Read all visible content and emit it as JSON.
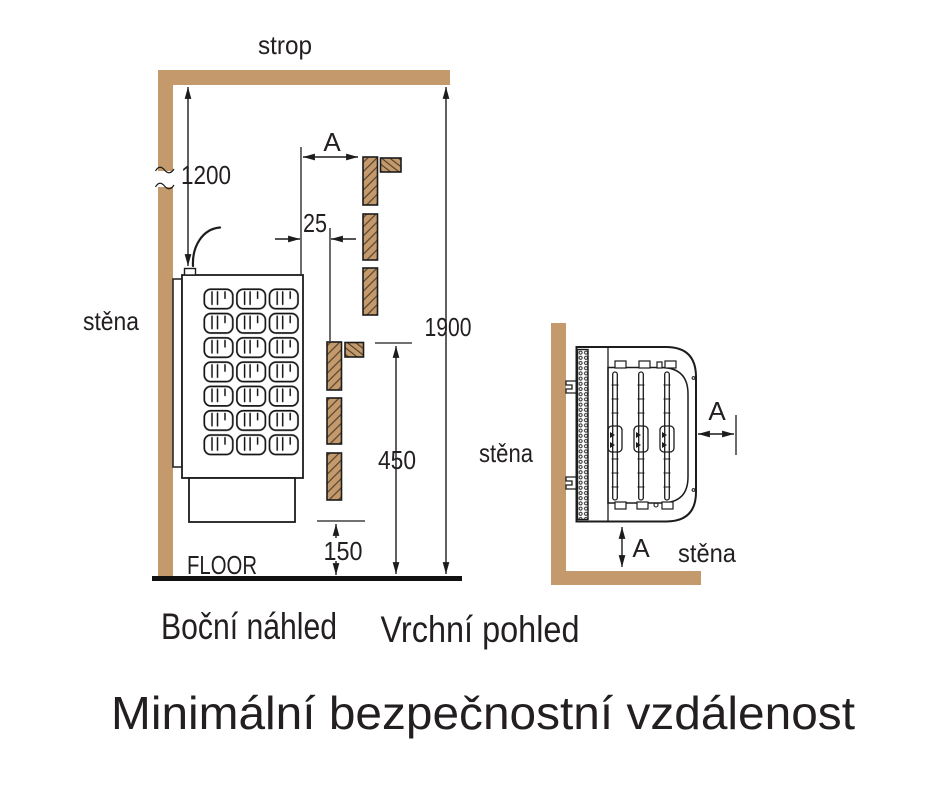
{
  "title": "Minimální bezpečnostní vzdálenost",
  "side_view": {
    "caption": "Boční náhled",
    "labels": {
      "ceiling": "strop",
      "wall": "stěna",
      "floor": "FLOOR"
    },
    "dimensions": {
      "heater_top_to_ceiling": "1200",
      "front_clearance_label": "A",
      "shield_air_gap": "25",
      "floor_to_ceiling_min": "1900",
      "shield_height": "450",
      "shield_bottom_gap": "150"
    }
  },
  "top_view": {
    "caption": "Vrchní pohled",
    "labels": {
      "side_wall": "stěna",
      "back_wall": "stěna"
    },
    "dimensions": {
      "side_clearance_label": "A",
      "back_clearance_label": "A"
    }
  },
  "colors": {
    "wood": "#C49A6C",
    "line": "#1C1C1C",
    "text": "#231F20",
    "floor": "#111111",
    "background": "#FFFFFF"
  }
}
